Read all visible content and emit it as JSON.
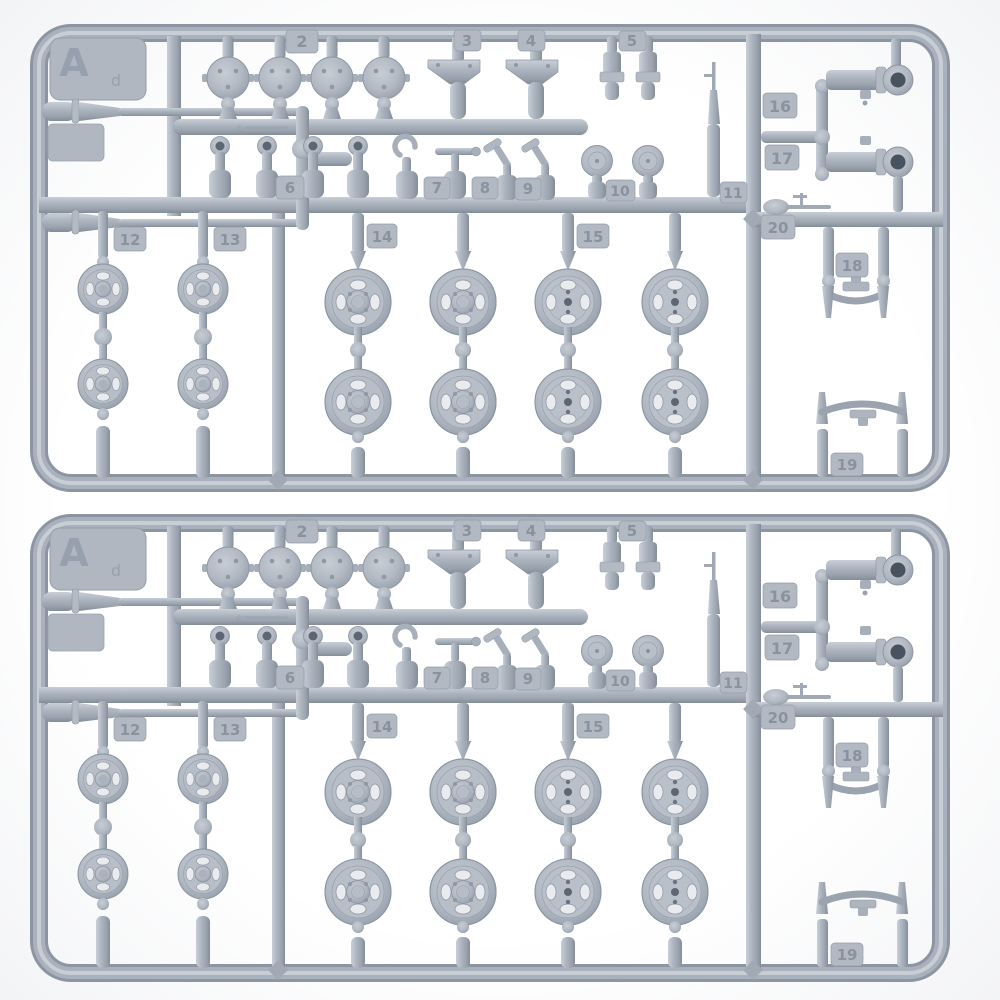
{
  "scene": {
    "background_color": "#ffffff",
    "plastic_base_color": "#a8b0bb",
    "plastic_highlight_color": "#cdd3da",
    "plastic_shadow_color": "#7e8793",
    "hole_color": "#5d6673",
    "sprue_count": 2
  },
  "sprue": {
    "corner_letter": "A",
    "corner_letter_sub": "d",
    "mold_copyright": "©",
    "tags": {
      "t2": "2",
      "t3": "3",
      "t4": "4",
      "t5": "5",
      "t6": "6",
      "t7": "7",
      "t8": "8",
      "t9": "9",
      "t10": "10",
      "t11": "11",
      "t12": "12",
      "t13": "13",
      "t14": "14",
      "t15": "15",
      "t16": "16",
      "t17": "17",
      "t18": "18",
      "t19": "19",
      "t20": "20"
    }
  }
}
